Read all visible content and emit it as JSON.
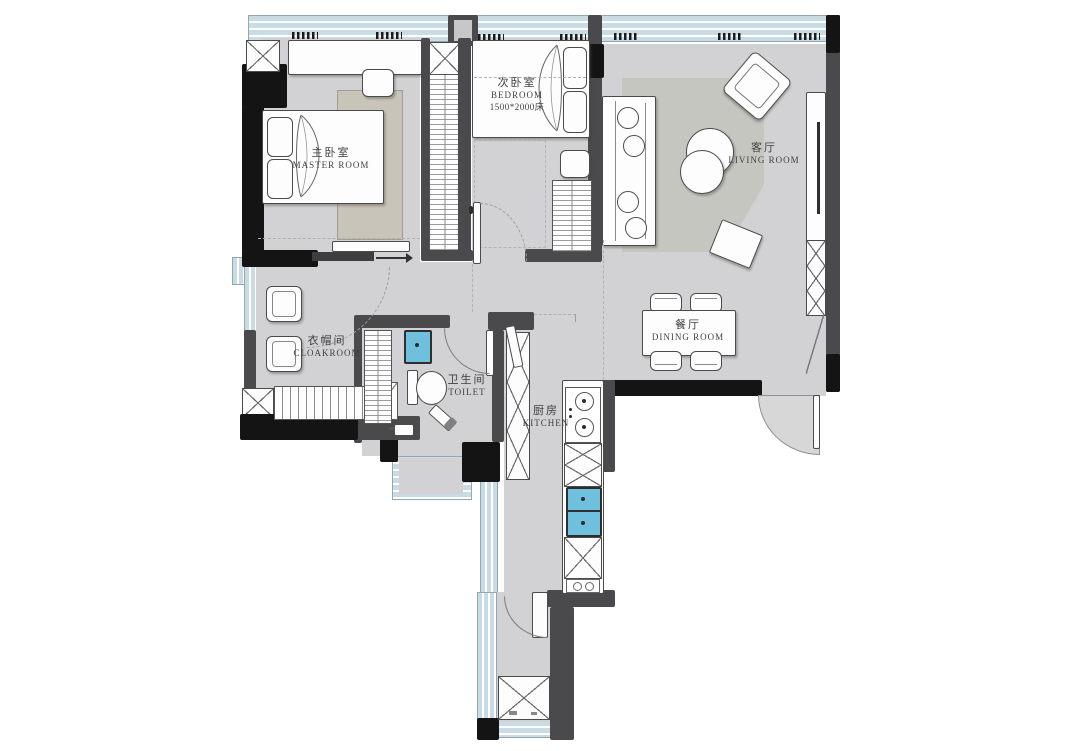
{
  "title": "Two-bedroom apartment floor plan",
  "rooms": [
    {
      "key": "master",
      "zh": "主卧室",
      "en": "MASTER ROOM"
    },
    {
      "key": "bedroom",
      "zh": "次卧室",
      "en": "BEDROOM",
      "note": "1500*2000床"
    },
    {
      "key": "living",
      "zh": "客厅",
      "en": "LIVING ROOM"
    },
    {
      "key": "cloakroom",
      "zh": "衣帽间",
      "en": "CLOAKROOM"
    },
    {
      "key": "toilet",
      "zh": "卫生间",
      "en": "TOILET"
    },
    {
      "key": "dining",
      "zh": "餐厅",
      "en": "DINING ROOM"
    },
    {
      "key": "kitchen",
      "zh": "厨房",
      "en": "KITCHEN"
    }
  ],
  "colors": {
    "floor": "#d2d2d4",
    "wall": "#4a4a4c",
    "wall_black": "#141414",
    "window": "#c9dbe4",
    "rug_master": "#c9c4b9",
    "rug_living": "#c6c6c0",
    "sink": "#6fc0dc",
    "furniture": "#fdfdfd",
    "outline": "#4a4a4a",
    "label_text": "#3f3f3f",
    "door_swing_fill": "#d7d7d7"
  }
}
